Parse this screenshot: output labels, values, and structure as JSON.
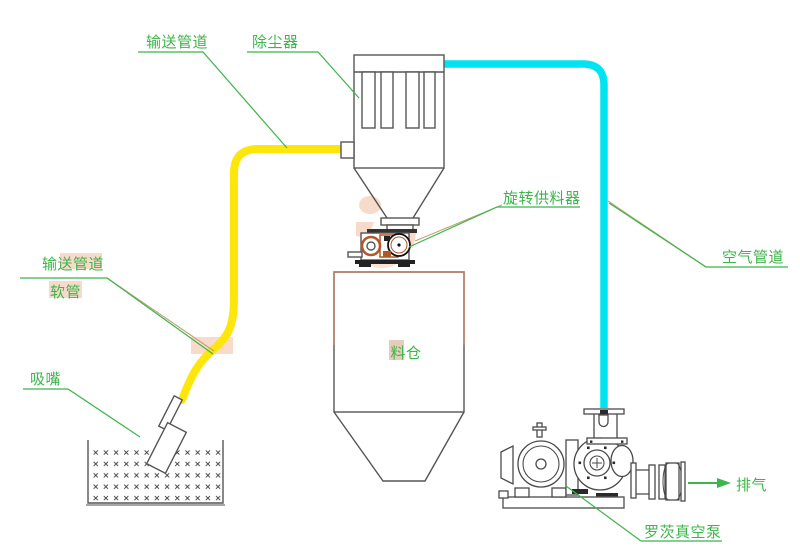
{
  "labels": {
    "conveying_pipe": "输送管道",
    "dust_collector": "除尘器",
    "rotary_feeder": "旋转供料器",
    "silo": "料仓",
    "hose_label_line1": "输送管道",
    "hose_label_line2": "软管",
    "suction_nozzle": "吸嘴",
    "air_pipe": "空气管道",
    "exhaust": "排气",
    "roots_vacuum_pump": "罗茨真空泵"
  },
  "colors": {
    "label_green": "#3cb54a",
    "pipe_yellow": "#ffe60a",
    "pipe_cyan": "#00e4f2",
    "leader_tan": "#bfa271",
    "outline_gray": "#555555",
    "feeder_orange": "#b3572a",
    "silo_brown": "#b97a5d",
    "highlight_salmon": "#f5c3aa"
  }
}
